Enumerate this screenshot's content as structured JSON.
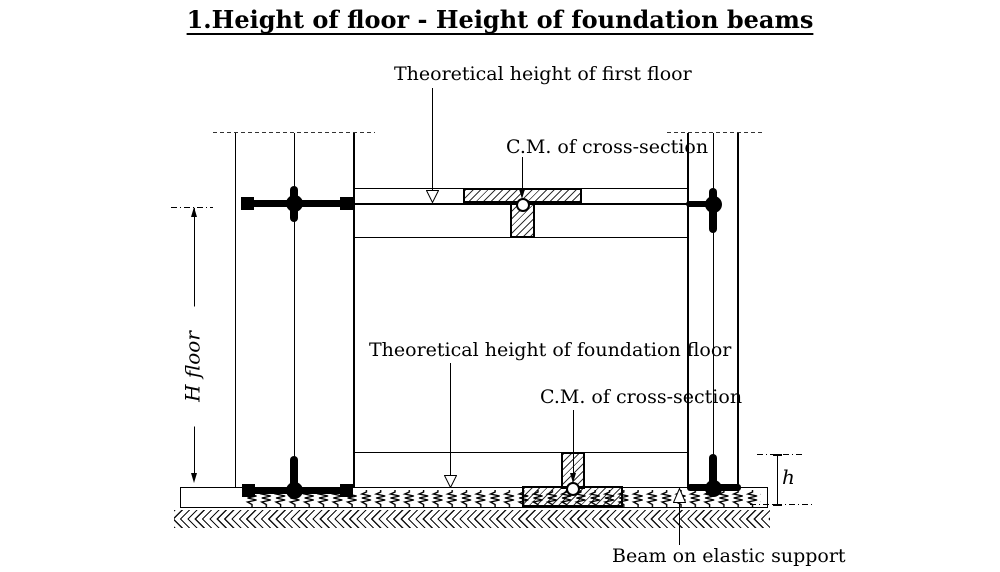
{
  "title": "1.Height of floor - Height of foundation beams",
  "labels": {
    "first_floor_height": "Theoretical height of first floor",
    "cm_first": "C.M. of cross-section",
    "foundation_floor_height": "Theoretical height of foundation floor",
    "cm_foundation": "C.M. of cross-section",
    "beam_support": "Beam on elastic support",
    "h_floor": "H floor",
    "h_small": "h"
  },
  "colors": {
    "line": "#000000",
    "background": "#ffffff"
  }
}
